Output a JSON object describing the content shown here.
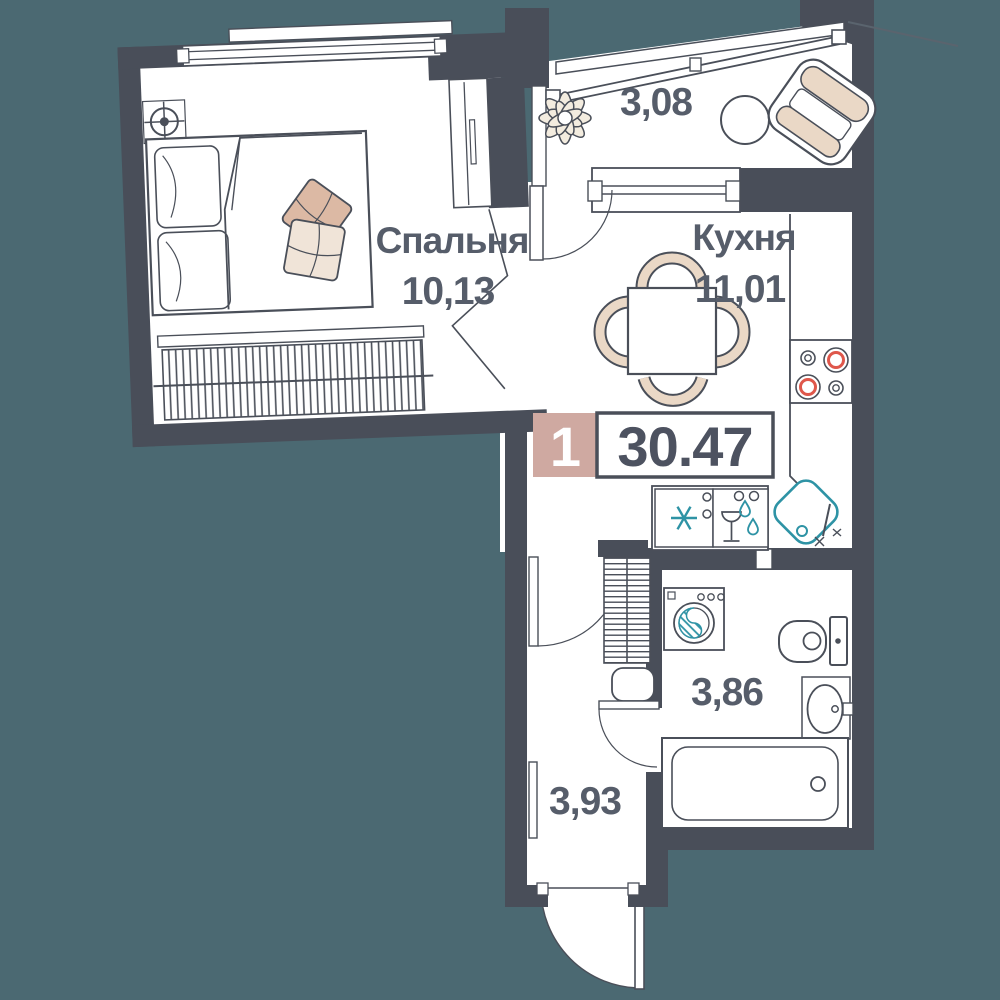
{
  "floor_plan": {
    "type": "apartment-floor-plan",
    "badge": {
      "rooms_count": "1",
      "total_area": "30.47"
    },
    "rooms": {
      "bedroom": {
        "name": "Спальня",
        "area": "10,13"
      },
      "kitchen": {
        "name": "Кухня",
        "area": "11,01"
      },
      "balcony": {
        "area": "3,08"
      },
      "bathroom": {
        "area": "3,86"
      },
      "hallway": {
        "area": "3,93"
      }
    },
    "colors": {
      "background": "#4b6972",
      "walls": "#494e59",
      "text": "#565d6a",
      "badge_unit_bg": "#cfa9a1",
      "accent_teal": "#2e93a5",
      "accent_red": "#df574b",
      "furniture_beige": "#ead8c6",
      "cushion_tan": "#dcb9a4",
      "cushion_cream": "#f0e4d8"
    },
    "icons": {
      "bed-icon": "double bed with pillows and cushions",
      "ceiling-light-icon": "circle with crosshair",
      "wardrobe-icon": "closet with sliding door",
      "radiator-icon": "hatched heating strip",
      "plant-icon": "flower with petals",
      "round-table-icon": "small circle table",
      "armchair-icon": "rotated armchair",
      "dining-table-icon": "square table with four chairs",
      "cooktop-icon": "four burners, two red rings",
      "fridge-icon": "snowflake asterisk",
      "dishwasher-icon": "wine glass with drops",
      "kitchen-sink-icon": "teal rounded diamond with tap",
      "washing-machine-icon": "drum with teal hatch",
      "toilet-icon": "bowl with tank",
      "washbasin-icon": "oval basin",
      "bathtub-icon": "rectangular tub with drain",
      "shelving-icon": "hatched storage unit",
      "pouf-icon": "rounded square seat",
      "door-icon": "leaf with quarter-circle swing arc",
      "window-icon": "double-line band in wall"
    }
  }
}
